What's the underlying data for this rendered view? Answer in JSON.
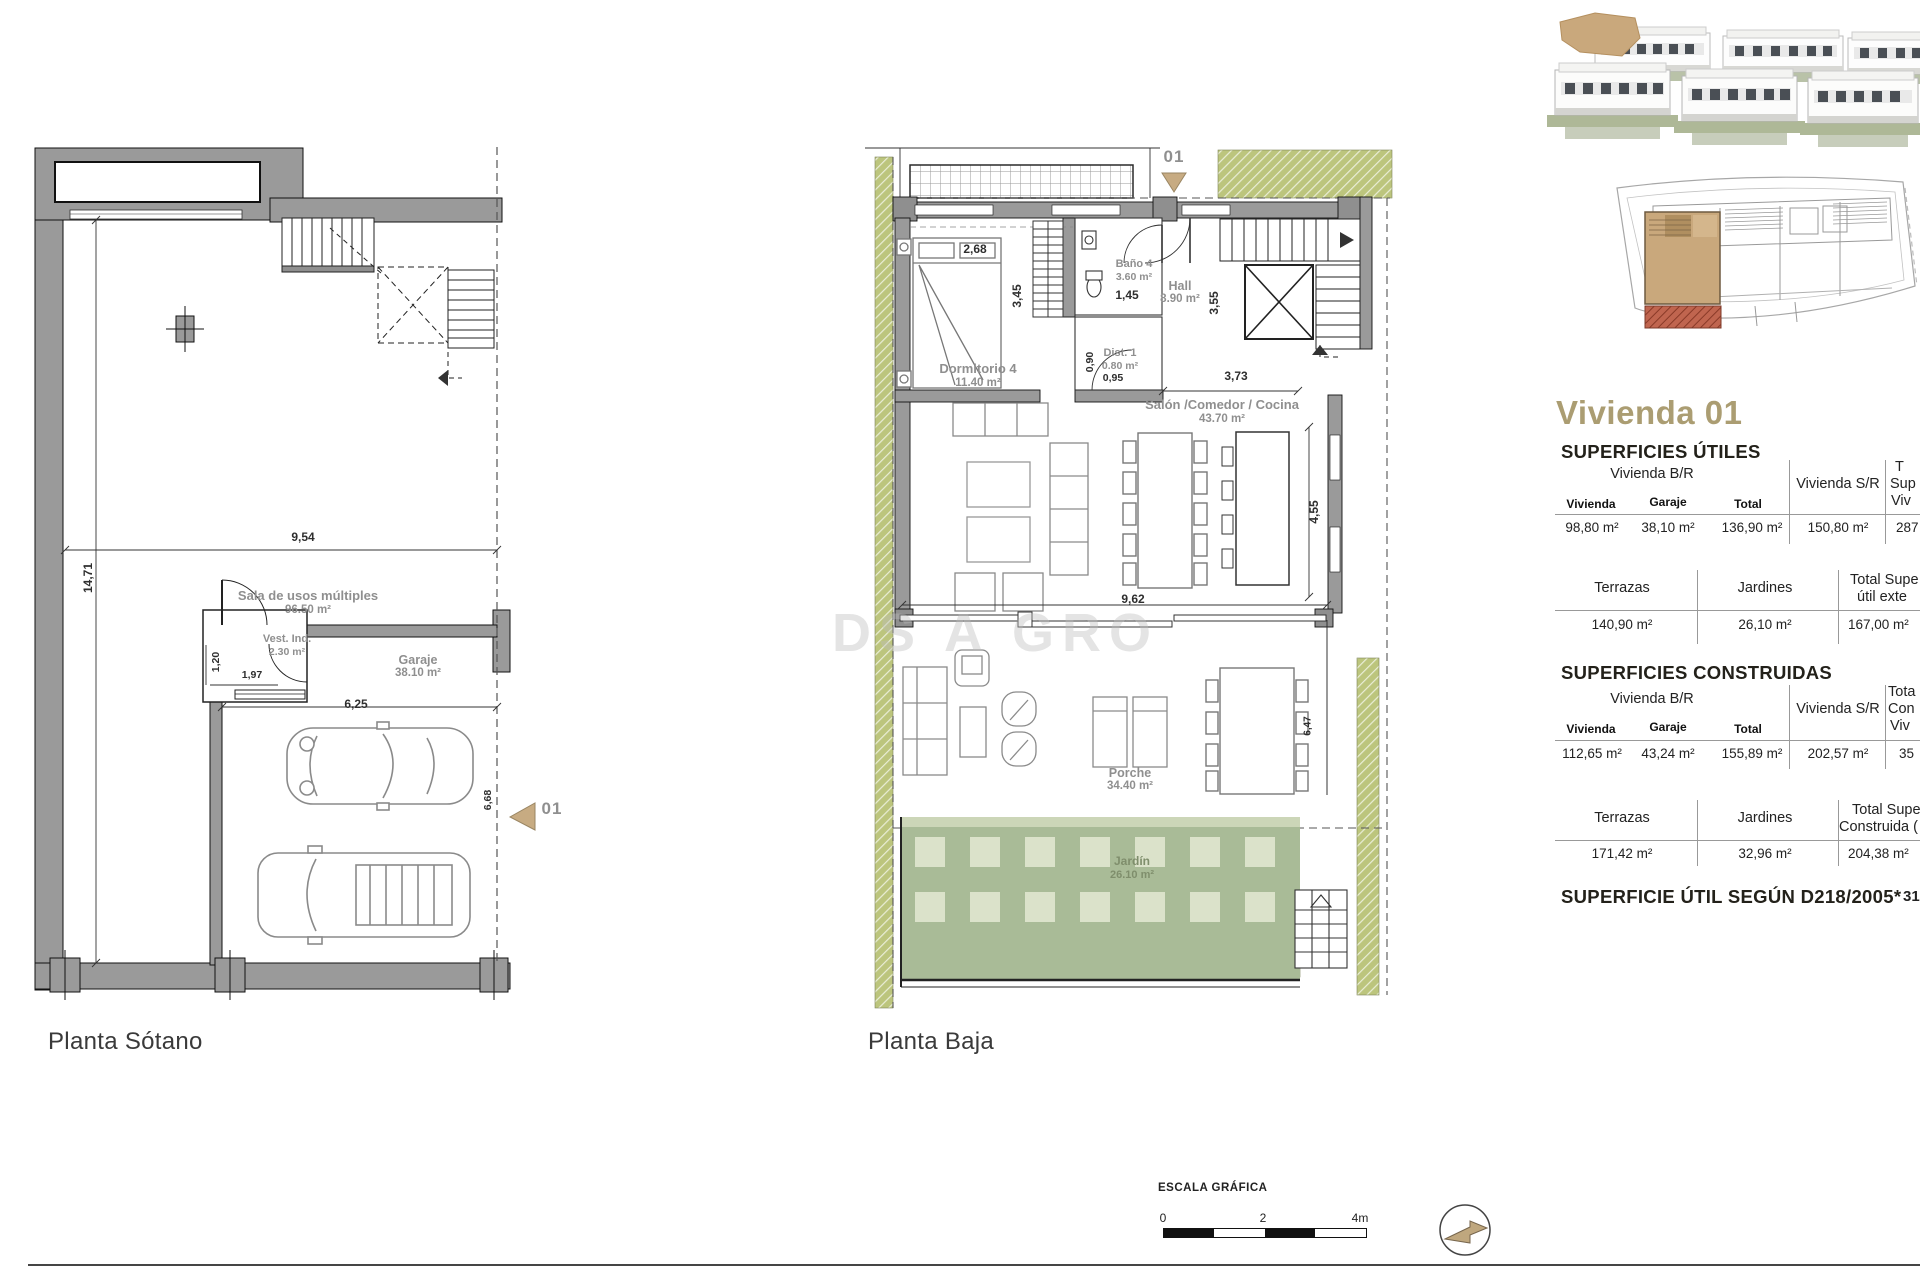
{
  "watermark": "DS A GRO",
  "plans": {
    "sotano": {
      "caption": "Planta Sótano",
      "marker": "01",
      "rooms": {
        "sala": {
          "name": "Sala de usos múltiples",
          "area": "96.50 m²"
        },
        "vest": {
          "name": "Vest. Ind.",
          "area": "2.30 m²"
        },
        "garaje": {
          "name": "Garaje",
          "area": "38.10 m²"
        }
      },
      "dims": {
        "total_w": "9,54",
        "total_h": "14,71",
        "vest_h": "1,20",
        "vest_w": "1,97",
        "garaje_w": "6,25",
        "garaje_h": "6,68"
      }
    },
    "baja": {
      "caption": "Planta Baja",
      "marker": "01",
      "rooms": {
        "dormitorio": {
          "name": "Dormitorio 4",
          "area": "11.40 m²"
        },
        "bano": {
          "name": "Baño 4",
          "area": "3.60 m²"
        },
        "dist": {
          "name": "Dist. 1",
          "area": "0.80 m²"
        },
        "hall": {
          "name": "Hall",
          "area": "8.90 m²"
        },
        "salon": {
          "name": "Salón /Comedor / Cocina",
          "area": "43.70 m²"
        },
        "porche": {
          "name": "Porche",
          "area": "34.40 m²"
        },
        "jardin": {
          "name": "Jardín",
          "area": "26.10 m²"
        }
      },
      "dims": {
        "bed_w": "2,68",
        "bed_h": "3,45",
        "bano_w": "1,45",
        "hall_h": "3,55",
        "dist_h": "0,90",
        "dist_w": "0,95",
        "hall_w": "3,73",
        "salon_h": "4,55",
        "salon_w": "9,62",
        "porche_h": "6,47"
      }
    }
  },
  "panel": {
    "title": "Vivienda 01",
    "superficies_utiles": {
      "heading": "SUPERFICIES ÚTILES",
      "table_main": {
        "group_header": "Vivienda B/R",
        "col_sr": "Vivienda S/R",
        "col_total_clipped": [
          "T",
          "Sup",
          "Viv"
        ],
        "sub_headers": [
          "Vivienda",
          "Garaje",
          "Total"
        ],
        "values": [
          "98,80 m²",
          "38,10 m²",
          "136,90 m²",
          "150,80 m²",
          "287"
        ]
      },
      "table_exterior": {
        "headers": [
          "Terrazas",
          "Jardines"
        ],
        "col_total_clipped": [
          "Total Supe",
          "útil exte"
        ],
        "values": [
          "140,90 m²",
          "26,10 m²",
          "167,00 m²"
        ]
      }
    },
    "superficies_construidas": {
      "heading": "SUPERFICIES CONSTRUIDAS",
      "table_main": {
        "group_header": "Vivienda B/R",
        "col_sr": "Vivienda S/R",
        "col_total_clipped": [
          "Tota",
          "Con",
          "Viv"
        ],
        "sub_headers": [
          "Vivienda",
          "Garaje",
          "Total"
        ],
        "values": [
          "112,65 m²",
          "43,24 m²",
          "155,89 m²",
          "202,57 m²",
          "35"
        ]
      },
      "table_exterior": {
        "headers": [
          "Terrazas",
          "Jardines"
        ],
        "col_total_clipped": [
          "Total Supe",
          "Construida ("
        ],
        "values": [
          "171,42 m²",
          "32,96 m²",
          "204,38 m²"
        ]
      }
    },
    "footnote": {
      "label": "SUPERFICIE ÚTIL SEGÚN D218/2005*",
      "value": "31"
    }
  },
  "scalebar": {
    "label": "ESCALA GRÁFICA",
    "t0": "0",
    "t2": "2",
    "t4": "4m"
  },
  "colors": {
    "accent_tan": "#ab9d72",
    "wall_gray": "#9a9a9a",
    "garden_green": "#a9bb97",
    "hatch_green": "#bcc57d",
    "highlight_tan": "#c9a87c",
    "red_hatch": "#a14b38"
  }
}
